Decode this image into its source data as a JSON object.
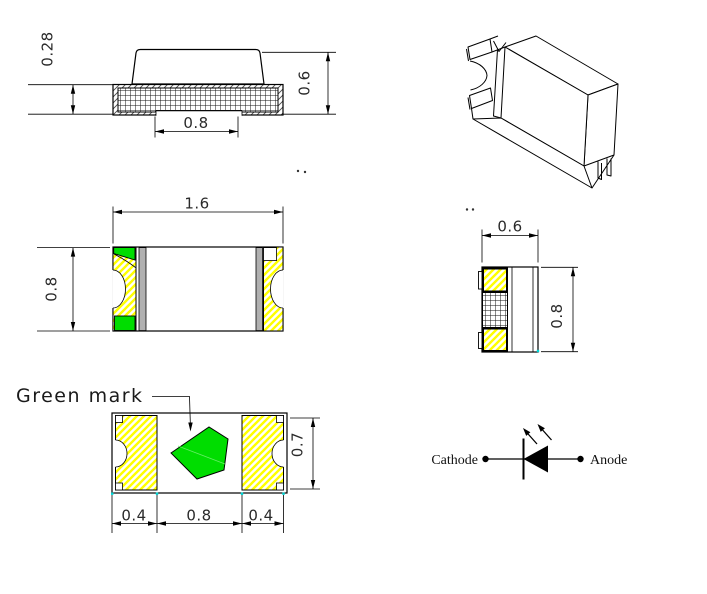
{
  "drawing": {
    "title_hint": "SMD chip LED package outline drawing",
    "side_view": {
      "base_height": "0.28",
      "total_height": "0.6",
      "bottom_slug_width": "0.8"
    },
    "top_view": {
      "length": "1.6",
      "width": "0.8"
    },
    "bottom_view": {
      "green_mark_label": "Green mark",
      "left_pad_width": "0.4",
      "center_width": "0.8",
      "right_pad_width": "0.4",
      "pad_height": "0.7"
    },
    "end_view": {
      "width": "0.6",
      "height": "0.8"
    },
    "symbol": {
      "cathode_label": "Cathode",
      "anode_label": "Anode"
    },
    "colors": {
      "green": "#00dd00",
      "yellow": "#ffff00",
      "gray": "#b0b0b0",
      "cyan_marker": "#00d5d5"
    }
  }
}
